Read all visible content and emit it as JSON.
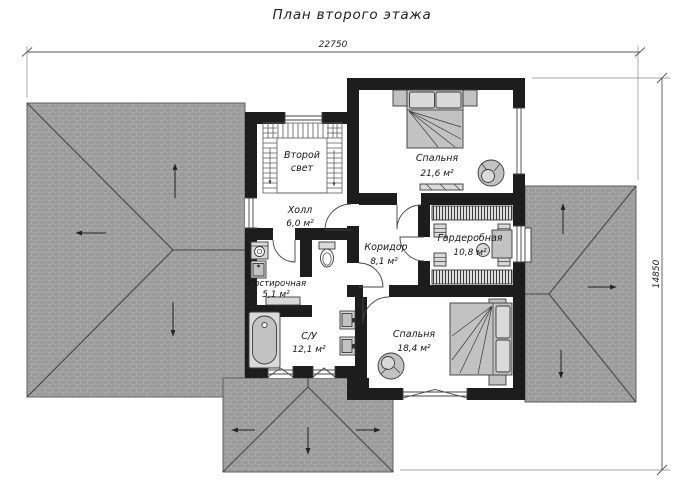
{
  "title": "План второго этажа",
  "dimensions": {
    "width_label": "22750",
    "height_label": "14850"
  },
  "rooms": {
    "second_light": {
      "line1": "Второй",
      "line2": "свет"
    },
    "hall": {
      "name": "Холл",
      "area": "6,0 м²"
    },
    "bedroom_top": {
      "name": "Спальня",
      "area": "21,6 м²"
    },
    "corridor": {
      "name": "Коридор",
      "area": "8,1 м²"
    },
    "wardrobe": {
      "name": "Гардеробная",
      "area": "10,8 м²"
    },
    "laundry": {
      "name": "Постирочная",
      "area": "5,1 м²"
    },
    "bathroom": {
      "name": "С/У",
      "area": "12,1 м²"
    },
    "bedroom_bottom": {
      "name": "Спальня",
      "area": "18,4 м²"
    }
  },
  "colors": {
    "wall_color": "#1d1d1d",
    "floor_color": "#ffffff",
    "roof_tile_color": "#9c9c9c",
    "roof_mortar_color": "#aeaeae",
    "furniture_color": "#c2c2c2",
    "line_color": "#3a3a3a"
  }
}
